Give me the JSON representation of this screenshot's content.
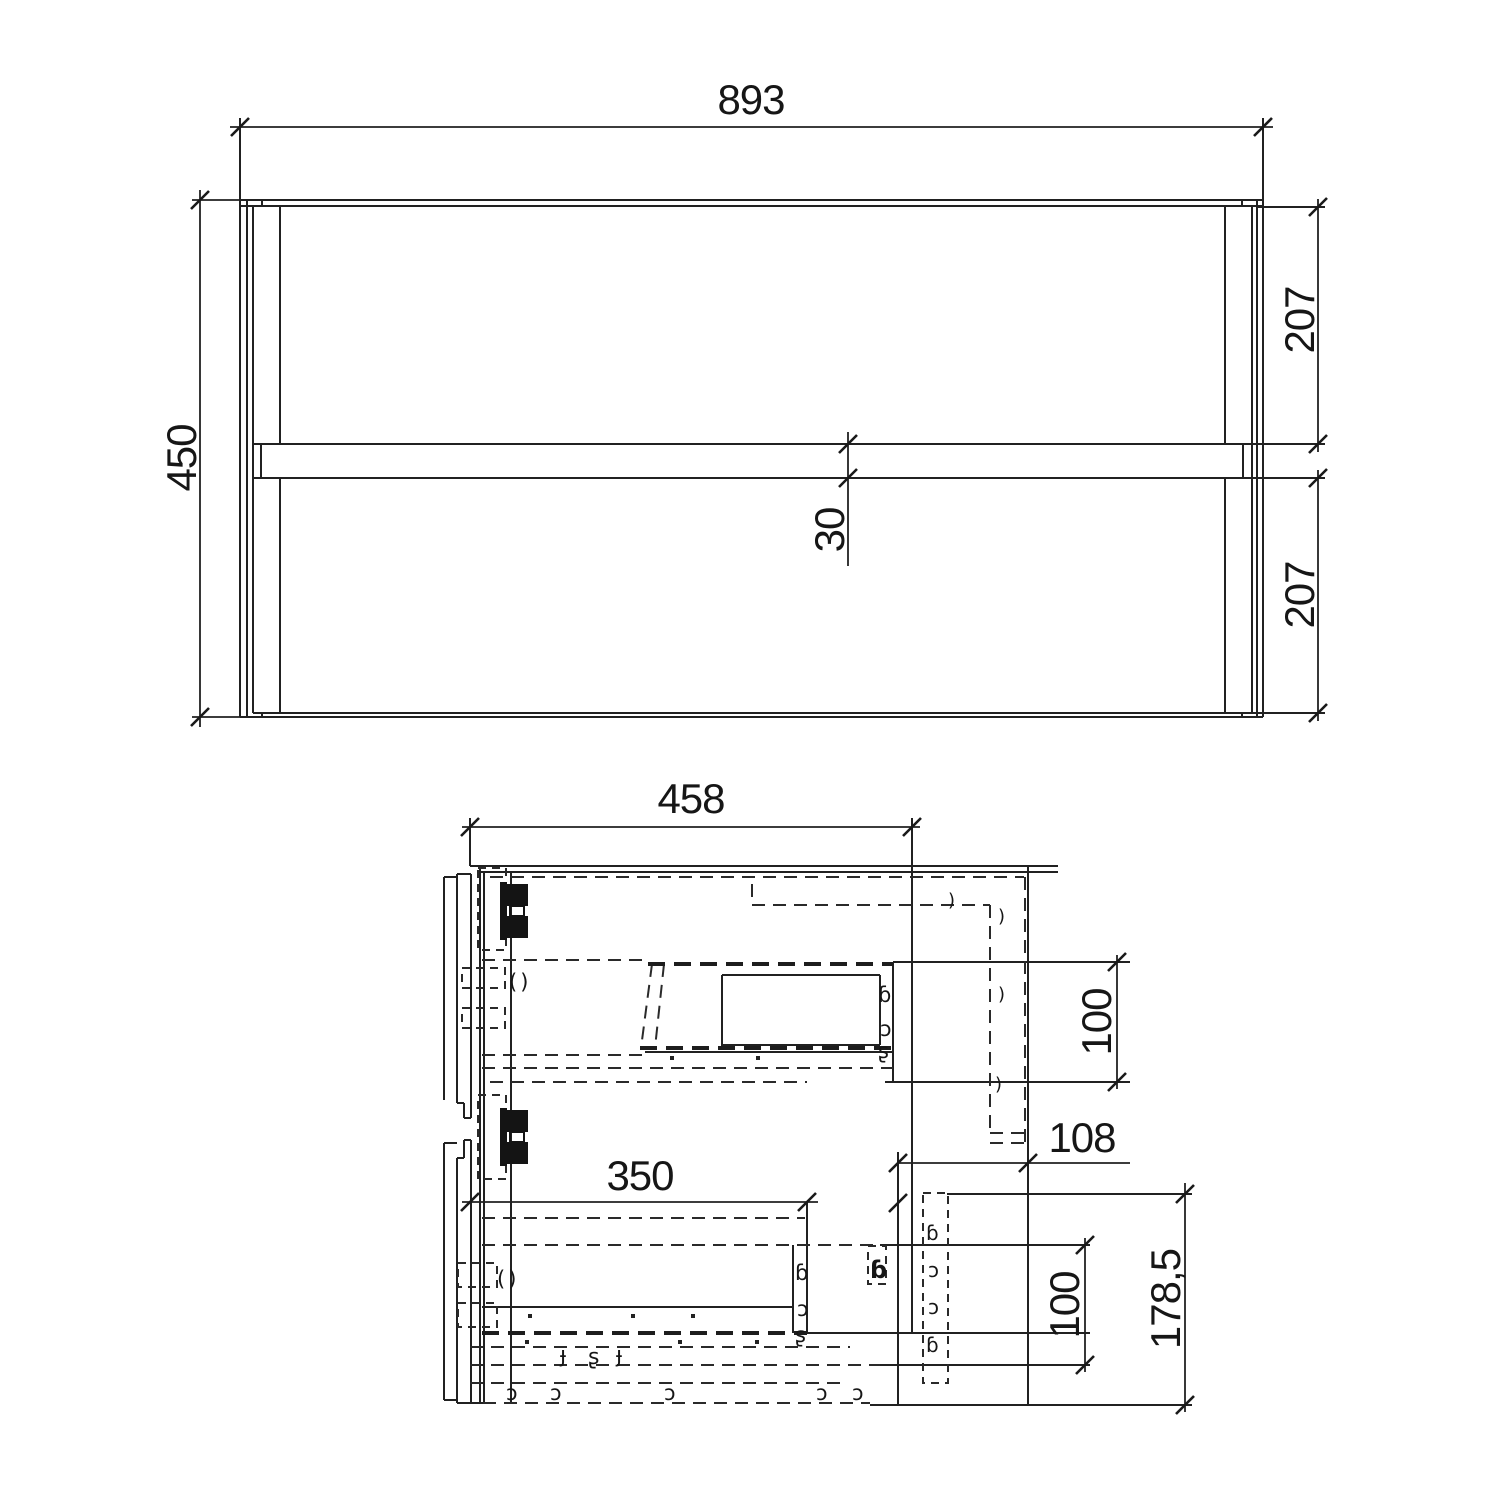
{
  "drawing": {
    "front_view": {
      "label": "front elevation",
      "width": "893",
      "height": "450",
      "upper_front_height": "207",
      "lower_front_height": "207",
      "front_gap": "30"
    },
    "side_view": {
      "label": "side section",
      "depth": "458",
      "upper_recess": "100",
      "back_clearance": "108",
      "inner_depth": "350",
      "lower_recess": "100",
      "lower_zone_height": "178,5"
    },
    "glyphs": {
      "paren_pair": "()",
      "paren": ")",
      "hook_b": "ɓ",
      "hook_c": "ɔ",
      "hook_s": "ʂ",
      "hook_f": "ɟ"
    },
    "colors": {
      "ink": "#212121",
      "background": "#ffffff"
    }
  }
}
